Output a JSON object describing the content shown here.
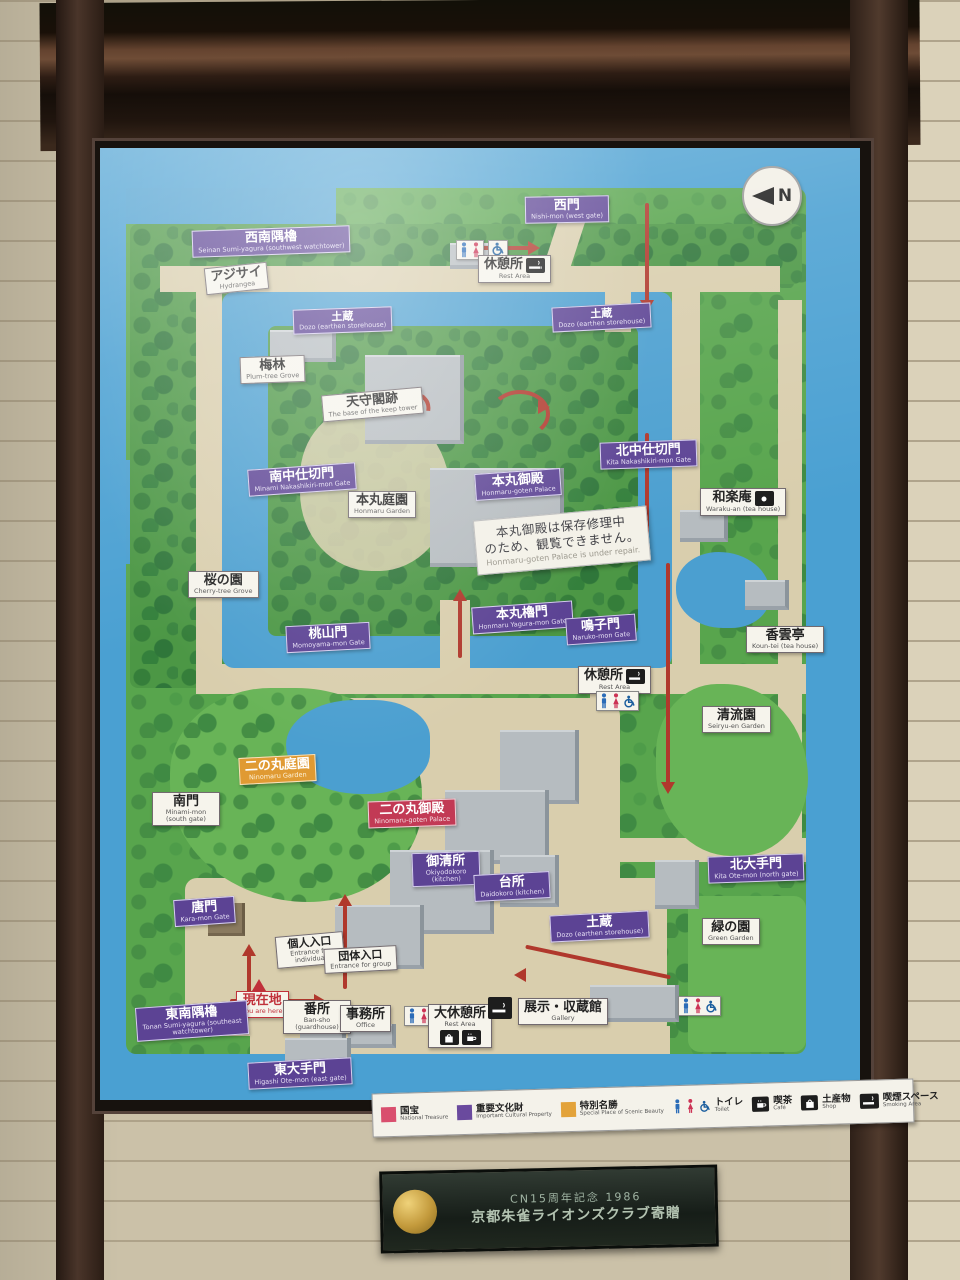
{
  "map": {
    "compass": "N",
    "labels": [
      {
        "id": "seinan-sumiyagura",
        "jp": "西南隅櫓",
        "en": "Seinan Sumi-yagura (southwest watchtower)",
        "type": "purple"
      },
      {
        "id": "ajisai",
        "jp": "アジサイ",
        "en": "Hydrangea",
        "type": "white"
      },
      {
        "id": "nishi-mon",
        "jp": "西門",
        "en": "Nishi-mon (west gate)",
        "type": "purple"
      },
      {
        "id": "rest-area-north",
        "jp": "休憩所",
        "en": "Rest Area",
        "type": "white",
        "icon": "smoking"
      },
      {
        "id": "dozo-west",
        "jp": "土蔵",
        "en": "Dozo (earthen storehouse)",
        "type": "purple"
      },
      {
        "id": "dozo-north",
        "jp": "土蔵",
        "en": "Dozo (earthen storehouse)",
        "type": "purple"
      },
      {
        "id": "bairin",
        "jp": "梅林",
        "en": "Plum-tree Grove",
        "type": "white"
      },
      {
        "id": "tenshukaku-ato",
        "jp": "天守閣跡",
        "en": "The base of the keep tower",
        "type": "white"
      },
      {
        "id": "minami-nakashikiri-mon",
        "jp": "南中仕切門",
        "en": "Minami Nakashikiri-mon Gate",
        "type": "purple"
      },
      {
        "id": "honmaru-garden",
        "jp": "本丸庭園",
        "en": "Honmaru Garden",
        "type": "white"
      },
      {
        "id": "honmaru-goten",
        "jp": "本丸御殿",
        "en": "Honmaru-goten Palace",
        "type": "purple"
      },
      {
        "id": "kita-nakashikiri-mon",
        "jp": "北中仕切門",
        "en": "Kita Nakashikiri-mon Gate",
        "type": "purple"
      },
      {
        "id": "waraku-an",
        "jp": "和楽庵",
        "en": "Waraku-an (tea house)",
        "type": "white",
        "icon": "camera"
      },
      {
        "id": "sakura-no-sono",
        "jp": "桜の園",
        "en": "Cherry-tree Grove",
        "type": "white"
      },
      {
        "id": "honmaru-yagura-mon",
        "jp": "本丸櫓門",
        "en": "Honmaru Yagura-mon Gate",
        "type": "purple"
      },
      {
        "id": "naruko-mon",
        "jp": "鳴子門",
        "en": "Naruko-mon Gate",
        "type": "purple"
      },
      {
        "id": "momoyama-mon",
        "jp": "桃山門",
        "en": "Momoyama-mon Gate",
        "type": "purple"
      },
      {
        "id": "koun-tei",
        "jp": "香雲亭",
        "en": "Koun-tei (tea house)",
        "type": "white"
      },
      {
        "id": "rest-area-mid",
        "jp": "休憩所",
        "en": "Rest Area",
        "type": "white",
        "icon": "smoking"
      },
      {
        "id": "seiryu-en",
        "jp": "清流園",
        "en": "Seiryu-en Garden",
        "type": "white"
      },
      {
        "id": "ninomaru-garden",
        "jp": "二の丸庭園",
        "en": "Ninomaru Garden",
        "type": "orange"
      },
      {
        "id": "minami-mon",
        "jp": "南門",
        "en": "Minami-mon (south gate)",
        "type": "white"
      },
      {
        "id": "ninomaru-goten",
        "jp": "二の丸御殿",
        "en": "Ninomaru-goten Palace",
        "type": "red"
      },
      {
        "id": "okiyodokoro",
        "jp": "御清所",
        "en": "Okiyodokoro (kitchen)",
        "type": "purple"
      },
      {
        "id": "daidokoro",
        "jp": "台所",
        "en": "Daidokoro (kitchen)",
        "type": "purple"
      },
      {
        "id": "kita-ote-mon",
        "jp": "北大手門",
        "en": "Kita Ote-mon (north gate)",
        "type": "purple"
      },
      {
        "id": "dozo-south",
        "jp": "土蔵",
        "en": "Dozo (earthen storehouse)",
        "type": "purple"
      },
      {
        "id": "green-garden",
        "jp": "緑の園",
        "en": "Green Garden",
        "type": "white"
      },
      {
        "id": "kara-mon",
        "jp": "唐門",
        "en": "Kara-mon Gate",
        "type": "purple"
      },
      {
        "id": "kojin-iriguchi",
        "jp": "個人入口",
        "en": "Entrance for individual",
        "type": "white"
      },
      {
        "id": "dantai-iriguchi",
        "jp": "団体入口",
        "en": "Entrance for group",
        "type": "white"
      },
      {
        "id": "genzaichi",
        "jp": "現在地",
        "en": "You are here",
        "type": "youhere"
      },
      {
        "id": "tonan-sumiyagura",
        "jp": "東南隅櫓",
        "en": "Tonan Sumi-yagura (southeast watchtower)",
        "type": "purple"
      },
      {
        "id": "bansho",
        "jp": "番所",
        "en": "Ban-sho (guardhouse)",
        "type": "white"
      },
      {
        "id": "jimusho",
        "jp": "事務所",
        "en": "Office",
        "type": "white"
      },
      {
        "id": "dai-kyukeijo",
        "jp": "大休憩所",
        "en": "Rest Area",
        "type": "white",
        "icons": [
          "shop",
          "cafe"
        ]
      },
      {
        "id": "gallery",
        "jp": "展示・収蔵館",
        "en": "Gallery",
        "type": "white"
      },
      {
        "id": "higashi-ote-mon",
        "jp": "東大手門",
        "en": "Higashi Ote-mon (east gate)",
        "type": "purple"
      }
    ],
    "repair_note": {
      "jp1": "本丸御殿は保存修理中",
      "jp2": "のため、観覧できません。",
      "en": "Honmaru-goten Palace is under repair."
    },
    "legend": {
      "items": [
        {
          "jp": "国宝",
          "en": "National Treasure",
          "swatch": "#d94f6e"
        },
        {
          "jp": "重要文化財",
          "en": "Important Cultural Property",
          "swatch": "#6a4a9e"
        },
        {
          "jp": "特別名勝",
          "en": "Special Place of Scenic Beauty",
          "swatch": "#e3a33a"
        },
        {
          "jp": "トイレ",
          "en": "Toilet",
          "icon": "toilet"
        },
        {
          "jp": "喫茶",
          "en": "Café",
          "icon": "cafe"
        },
        {
          "jp": "土産物",
          "en": "Shop",
          "icon": "shop"
        },
        {
          "jp": "喫煙スペース",
          "en": "Smoking Area",
          "icon": "smoking"
        }
      ]
    },
    "colors": {
      "moat": "#4aa0d2",
      "grounds_green": "#58a54d",
      "path_tan": "#d9cead",
      "label_purple": "#5c4394",
      "label_red": "#c23a55",
      "label_orange": "#e09a33",
      "route_red": "#b0382c"
    },
    "plaque": {
      "line1": "CN15周年記念 1986",
      "line2": "京都朱雀ライオンズクラブ寄贈"
    }
  }
}
